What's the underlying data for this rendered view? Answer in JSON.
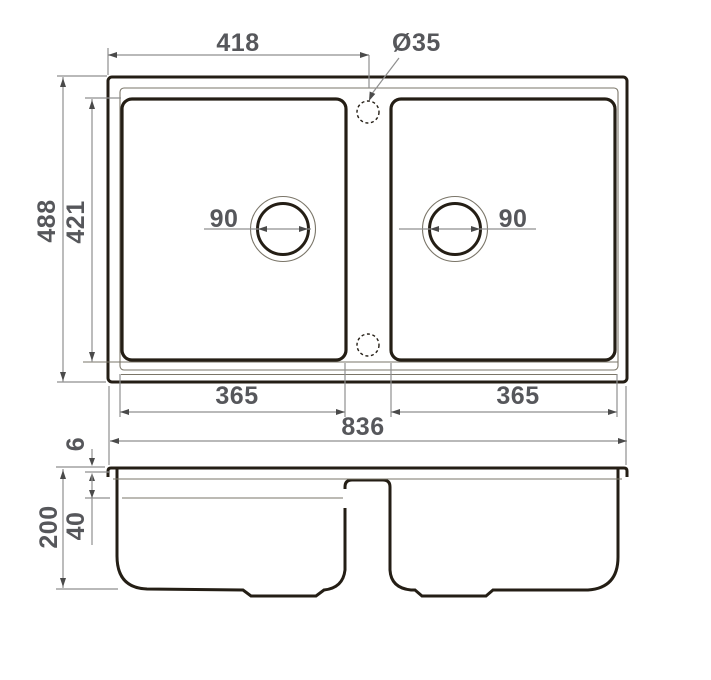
{
  "drawing": {
    "title": "Double-bowl sink dimensional drawing",
    "dims": {
      "top_width": "418",
      "tap_hole_diameter": "Ø35",
      "overall_front_back": "488",
      "bowl_front_back": "421",
      "drain_left": "90",
      "drain_right": "90",
      "bowl_left_width": "365",
      "bowl_right_width": "365",
      "overall_width": "836",
      "rim_thickness": "6",
      "overall_height": "200",
      "ledge_depth": "40"
    },
    "colors": {
      "outline": "#241e15",
      "thin_line": "#7a7568",
      "dimension_line": "#8f8f8f",
      "dimension_text": "#56575b",
      "background": "#ffffff"
    }
  }
}
